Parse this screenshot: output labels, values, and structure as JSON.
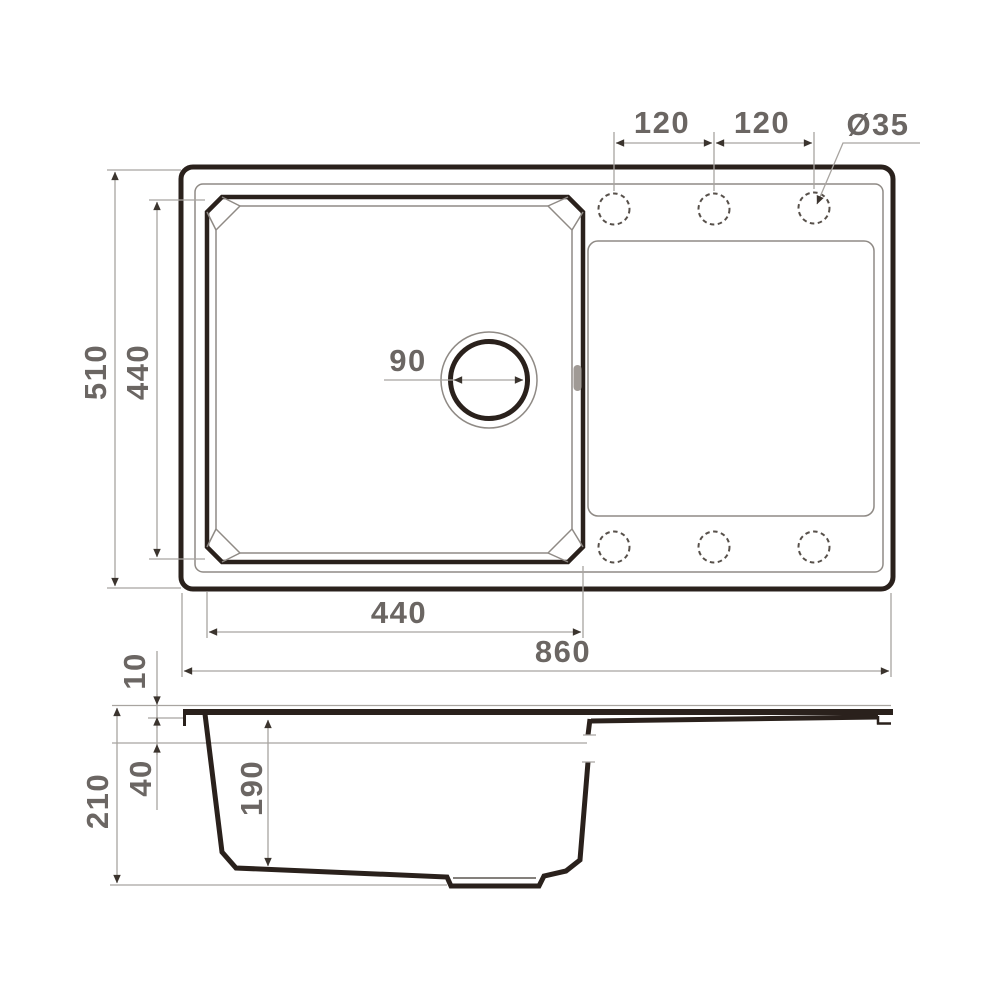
{
  "labels": {
    "hole_spacing_left": "120",
    "hole_spacing_right": "120",
    "hole_diameter": "Ø35",
    "overall_depth": "510",
    "bowl_depth": "440",
    "drain_diameter": "90",
    "bowl_width": "440",
    "overall_width": "860",
    "rim_height": "10",
    "edge_height": "40",
    "total_height": "210",
    "bowl_inner_depth": "190"
  },
  "colors": {
    "ink": "#2a211c",
    "thin": "#8f8a85",
    "dim": "#a8a4a0",
    "arrow": "#3b342e",
    "txt": "#6b6663",
    "dash": "#57504a",
    "bg": "#ffffff"
  }
}
